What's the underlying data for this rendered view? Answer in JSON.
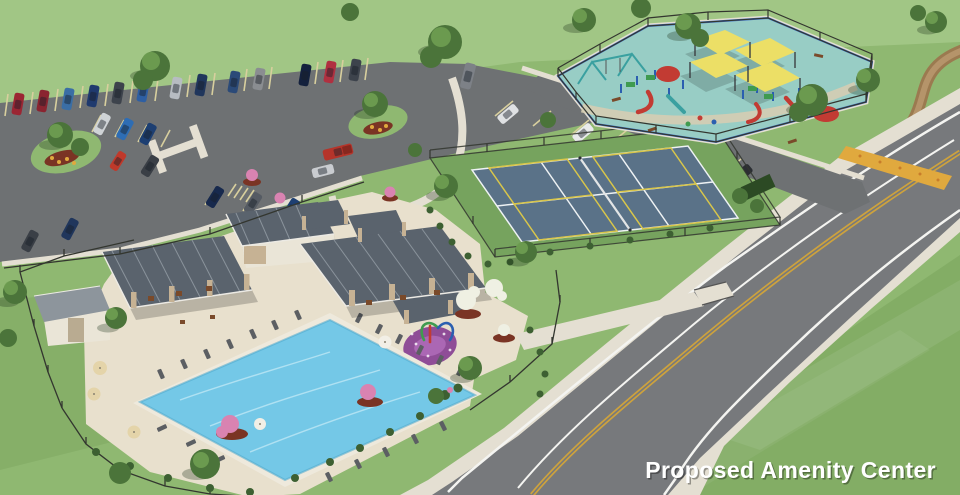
{
  "caption": {
    "text": "Proposed Amenity Center",
    "color": "#ffffff",
    "shadow": "rgba(0,0,0,0.35)"
  },
  "palette": {
    "grass_base": "#8fb871",
    "grass_light": "#b9d89e",
    "grass_shade": "#6d9950",
    "asphalt": "#6e7173",
    "road_asphalt": "#77797c",
    "concrete": "#e4dfd2",
    "stall_stripe": "#d8cf9e",
    "line_white": "#f4f4f1",
    "line_yellow": "#cda23d",
    "trail": "#9b7a50",
    "trail_light": "#b5946a",
    "pool_water": "#74c8e7",
    "pool_ripple": "#c9ecf7",
    "pool_coping": "#eee9dc",
    "deck": "#e8e0cd",
    "splash_pad": "#8f4d97",
    "splash_pad_light": "#b06cb8",
    "court_surface": "#5a7288",
    "court_surround": "#76a35e",
    "court_line": "#eef2f4",
    "pickleball_line": "#d9c64a",
    "playground_surface": "#98cdc5",
    "playground_border": "#3a6bc4",
    "playground_path": "#d5cdb2",
    "shade_sail": "#ecdf66",
    "roof": "#5a636d",
    "roof_ridge": "#9aa3ab",
    "fascia": "#eceae4",
    "stone": "#c6b294",
    "wall": "#eae5d7",
    "shed_roof": "#8d959c",
    "fence": "#33362f",
    "tree_dark": "#4b743a",
    "tree_light": "#71a153",
    "shrub": "#3d6032",
    "mulch": "#7a3424",
    "flower_yellow": "#e0a93e",
    "flower_pink": "#d983b1",
    "flower_white": "#eff0e3",
    "umbrella_tan": "#e4d4a9",
    "umbrella_white": "#f2efe6",
    "lounge_chair": "#5c5f63",
    "bench": "#7a4a2a",
    "equip_red": "#c23b33",
    "equip_blue": "#2b5fb0",
    "equip_green": "#3f9b4f",
    "equip_teal": "#3aa0a0"
  },
  "scene": {
    "parking": {
      "car_colors": [
        "#9b2633",
        "#8a2430",
        "#3a6ea5",
        "#1f3a6e",
        "#3d434c",
        "#2e5fa3",
        "#b7bcc2",
        "#20365c",
        "#2b4a78",
        "#8a8d91",
        "#14213d",
        "#b03040",
        "#3d434c",
        "#7d8187",
        "#cfd3d6",
        "#2e6db4",
        "#1d3f72",
        "#c0392b",
        "#3a3f46",
        "#b5342a",
        "#c9ccd0",
        "#17294d",
        "#555b63",
        "#1d3f72",
        "#20365c",
        "#3a3f46",
        "#dfe1e3",
        "#e9eaeb",
        "#a8222e",
        "#6e7378",
        "#585d64",
        "#2b2e33"
      ]
    }
  }
}
